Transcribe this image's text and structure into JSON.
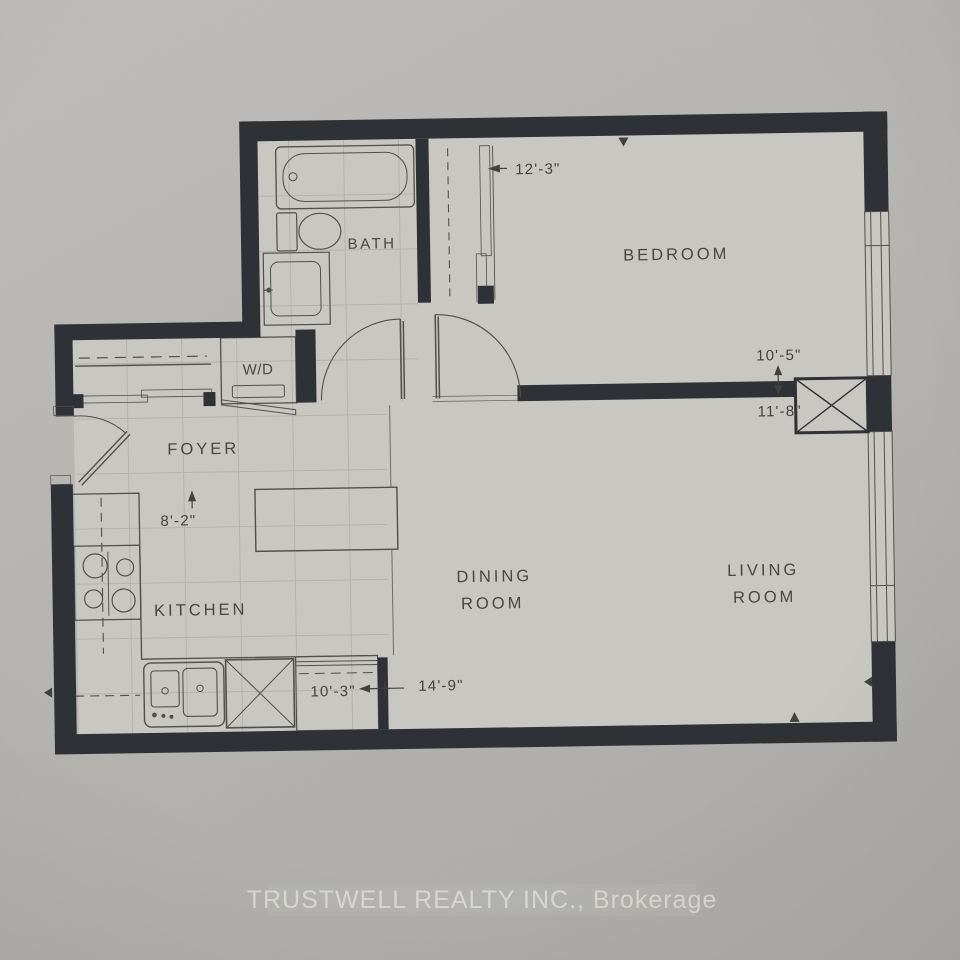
{
  "floor_plan": {
    "rooms": {
      "bath": {
        "label": "BATH"
      },
      "laundry_closet": {
        "label": "W/D"
      },
      "foyer": {
        "label": "FOYER"
      },
      "kitchen": {
        "label": "KITCHEN"
      },
      "bedroom": {
        "label": "BEDROOM"
      },
      "dining_room": {
        "label_line1": "DINING",
        "label_line2": "ROOM"
      },
      "living_room": {
        "label_line1": "LIVING",
        "label_line2": "ROOM"
      }
    },
    "dimensions": {
      "bedroom_width": "12'-3\"",
      "bedroom_depth": "10'-5\"",
      "living_room_width": "11'-8\"",
      "foyer_kitchen_width": "8'-2\"",
      "kitchen_length": "10'-3\"",
      "living_dining_length": "14'-9\""
    },
    "colors": {
      "wall": "#2b2e32",
      "paper": "#b6b5b1",
      "floor": "#c8c7c2",
      "linework": "#4e4d48",
      "footer_text": "#dbdad5"
    }
  },
  "footer": {
    "brokerage_text": "TRUSTWELL REALTY INC., Brokerage"
  }
}
